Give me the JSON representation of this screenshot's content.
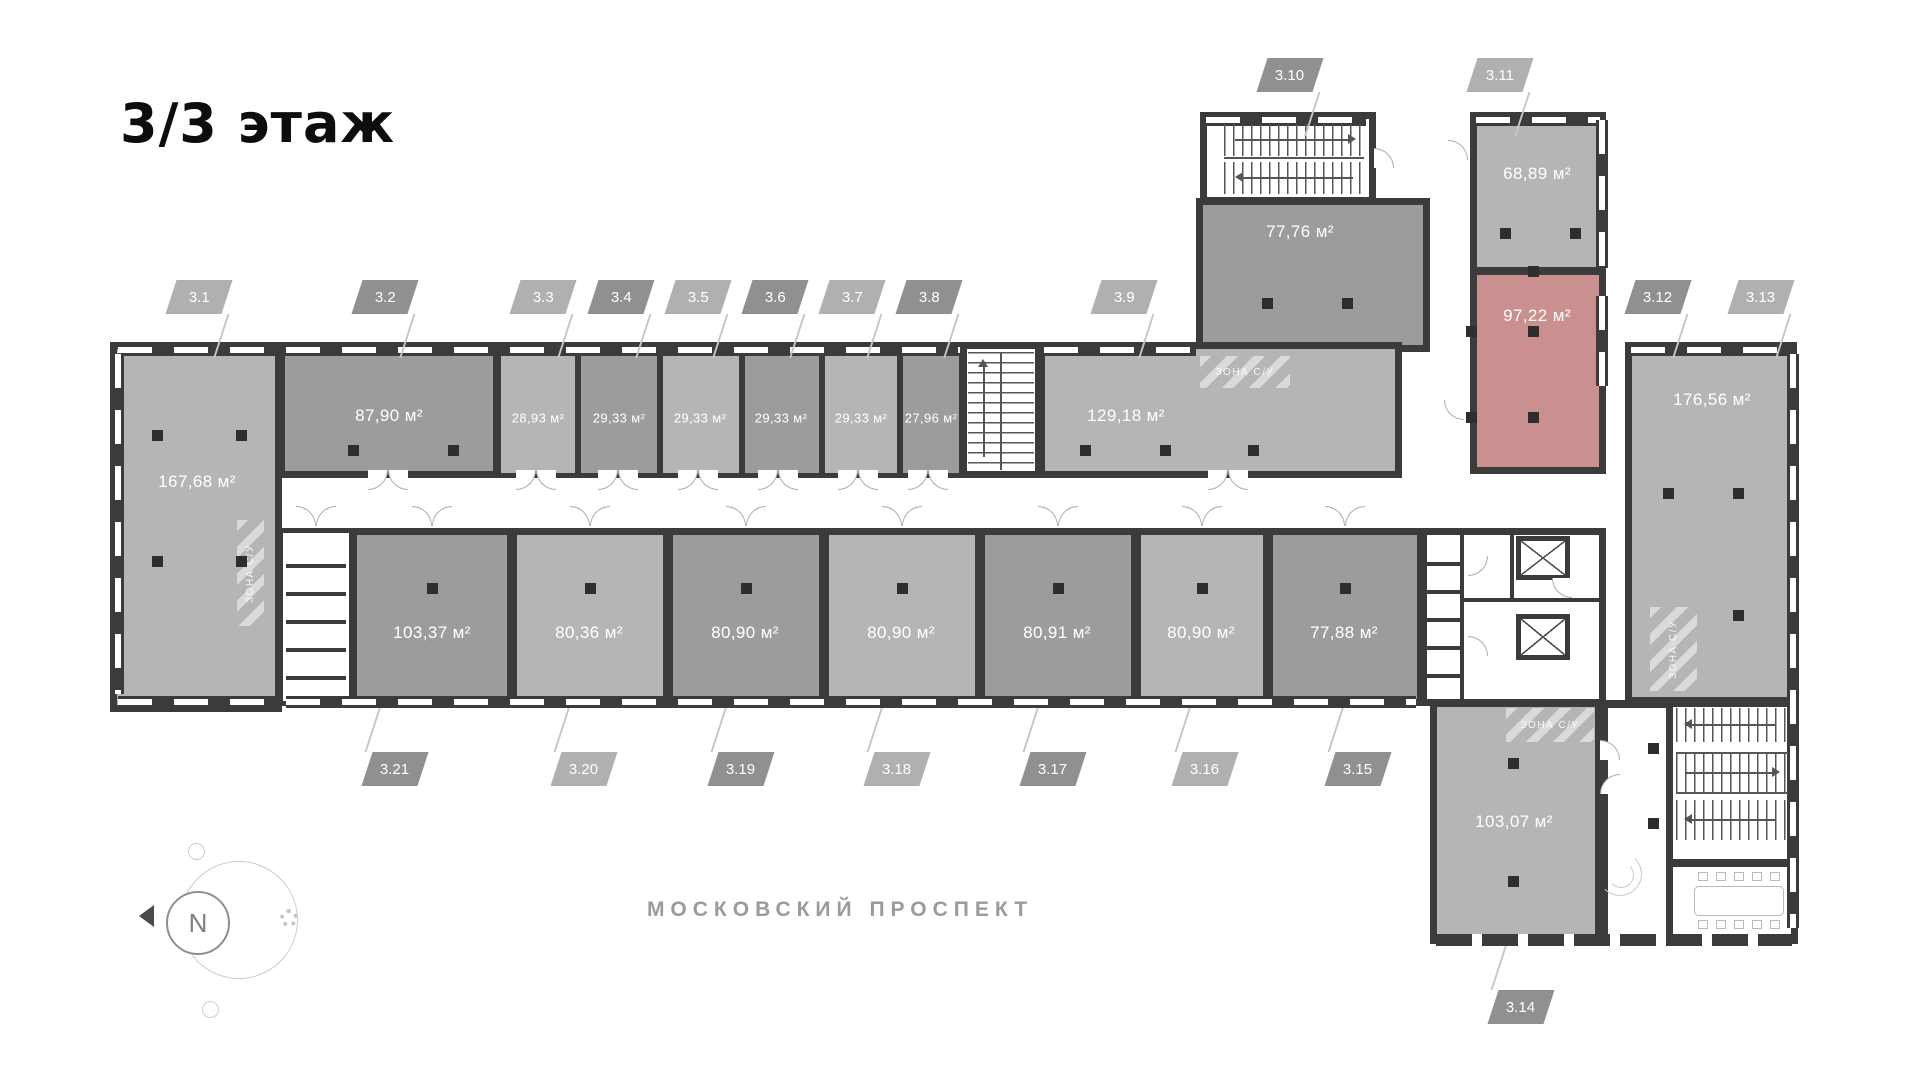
{
  "page": {
    "title": "3/3 этаж",
    "street_label": "МОСКОВСКИЙ ПРОСПЕКТ",
    "compass_letter": "N",
    "zone_label": "ЗОНА С/У"
  },
  "colors": {
    "highlight": "#c9908f",
    "wall": "#3b3b3b",
    "room_light": "#b5b5b5",
    "room_dark": "#9c9c9c",
    "tag_light": "#b0b0b0",
    "tag_dark": "#909090"
  },
  "units": [
    {
      "tag": "3.1",
      "area": "167,68 м²"
    },
    {
      "tag": "3.2",
      "area": "87,90 м²"
    },
    {
      "tag": "3.3",
      "area": "28,93 м²"
    },
    {
      "tag": "3.4",
      "area": "29,33 м²"
    },
    {
      "tag": "3.5",
      "area": "29,33 м²"
    },
    {
      "tag": "3.6",
      "area": "29,33 м²"
    },
    {
      "tag": "3.7",
      "area": "29,33 м²"
    },
    {
      "tag": "3.8",
      "area": "27,96 м²"
    },
    {
      "tag": "3.9",
      "area": "129,18 м²"
    },
    {
      "tag": "3.10",
      "area": ""
    },
    {
      "tag": "3.11",
      "area": "68,89 м²"
    },
    {
      "tag": "3.12",
      "area": "97,22 м²",
      "highlighted": true
    },
    {
      "tag": "3.13",
      "area": "176,56 м²"
    },
    {
      "tag": "3.14",
      "area": "103,07 м²"
    },
    {
      "tag": "3.15",
      "area": "77,88 м²"
    },
    {
      "tag": "3.16",
      "area": "80,90 м²"
    },
    {
      "tag": "3.17",
      "area": "80,91 м²"
    },
    {
      "tag": "3.18",
      "area": "80,90 м²"
    },
    {
      "tag": "3.19",
      "area": "80,90 м²"
    },
    {
      "tag": "3.20",
      "area": "80,36 м²"
    },
    {
      "tag": "3.21",
      "area": "103,37 м²"
    }
  ]
}
